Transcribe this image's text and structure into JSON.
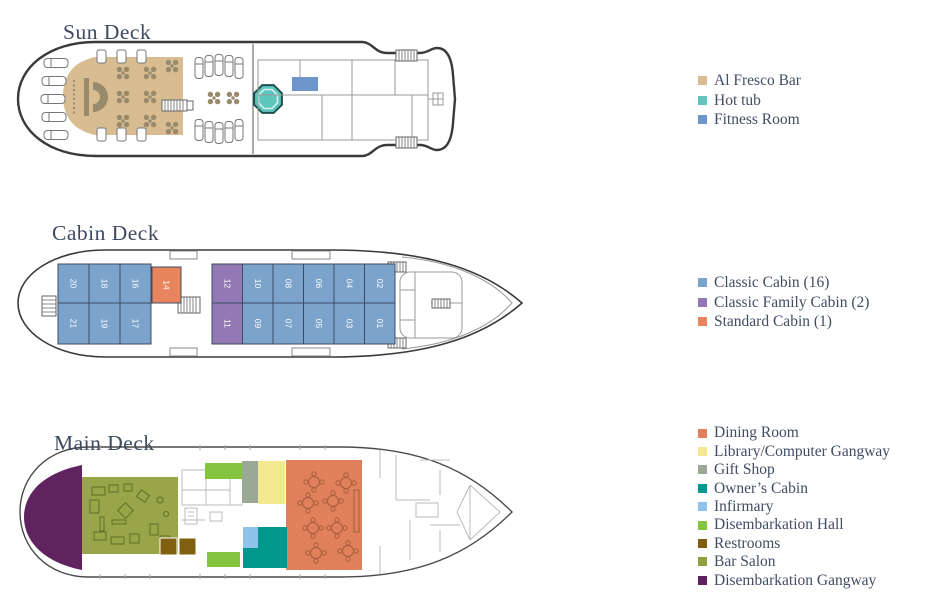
{
  "colors": {
    "text": "#414d63",
    "hull": "#3a3a3a",
    "structure": "#9a9a9a",
    "deck_decor": "#9a8a6c"
  },
  "decks": {
    "sun": {
      "title": "Sun Deck",
      "legend": [
        {
          "label": "Al Fresco Bar",
          "color": "#d8bd92"
        },
        {
          "label": "Hot tub",
          "color": "#5ec7bd"
        },
        {
          "label": "Fitness Room",
          "color": "#6d96cc"
        }
      ]
    },
    "cabin": {
      "title": "Cabin Deck",
      "legend": [
        {
          "label": "Classic Cabin (16)",
          "color": "#7ba3cc"
        },
        {
          "label": "Classic Family Cabin (2)",
          "color": "#9279b5"
        },
        {
          "label": "Standard Cabin (1)",
          "color": "#e8845e"
        }
      ],
      "cabins": [
        {
          "number": "20",
          "type": "classic",
          "group": "aft",
          "row": "top",
          "col": 0
        },
        {
          "number": "18",
          "type": "classic",
          "group": "aft",
          "row": "top",
          "col": 1
        },
        {
          "number": "16",
          "type": "classic",
          "group": "aft",
          "row": "top",
          "col": 2
        },
        {
          "number": "21",
          "type": "classic",
          "group": "aft",
          "row": "bottom",
          "col": 0
        },
        {
          "number": "19",
          "type": "classic",
          "group": "aft",
          "row": "bottom",
          "col": 1
        },
        {
          "number": "17",
          "type": "classic",
          "group": "aft",
          "row": "bottom",
          "col": 2
        },
        {
          "number": "14",
          "type": "standard",
          "group": "mid",
          "row": "top",
          "col": 0
        },
        {
          "number": "12",
          "type": "family",
          "group": "fwd",
          "row": "top",
          "col": 0
        },
        {
          "number": "10",
          "type": "classic",
          "group": "fwd",
          "row": "top",
          "col": 1
        },
        {
          "number": "08",
          "type": "classic",
          "group": "fwd",
          "row": "top",
          "col": 2
        },
        {
          "number": "06",
          "type": "classic",
          "group": "fwd",
          "row": "top",
          "col": 3
        },
        {
          "number": "04",
          "type": "classic",
          "group": "fwd",
          "row": "top",
          "col": 4
        },
        {
          "number": "02",
          "type": "classic",
          "group": "fwd",
          "row": "top",
          "col": 5
        },
        {
          "number": "11",
          "type": "family",
          "group": "fwd",
          "row": "bottom",
          "col": 0
        },
        {
          "number": "09",
          "type": "classic",
          "group": "fwd",
          "row": "bottom",
          "col": 1
        },
        {
          "number": "07",
          "type": "classic",
          "group": "fwd",
          "row": "bottom",
          "col": 2
        },
        {
          "number": "05",
          "type": "classic",
          "group": "fwd",
          "row": "bottom",
          "col": 3
        },
        {
          "number": "03",
          "type": "classic",
          "group": "fwd",
          "row": "bottom",
          "col": 4
        },
        {
          "number": "01",
          "type": "classic",
          "group": "fwd",
          "row": "bottom",
          "col": 5
        }
      ]
    },
    "main": {
      "title": "Main Deck",
      "legend": [
        {
          "label": "Dining Room",
          "color": "#e0815c"
        },
        {
          "label": "Library/Computer Gangway",
          "color": "#f5e98f"
        },
        {
          "label": "Gift Shop",
          "color": "#9aa896"
        },
        {
          "label": "Owner’s Cabin",
          "color": "#00988c"
        },
        {
          "label": "Infirmary",
          "color": "#8fc3ec"
        },
        {
          "label": "Disembarkation Hall",
          "color": "#85c440"
        },
        {
          "label": "Restrooms",
          "color": "#7e600f"
        },
        {
          "label": "Bar Salon",
          "color": "#92a13f"
        },
        {
          "label": "Disembarkation Gangway",
          "color": "#5f2360"
        }
      ]
    }
  }
}
